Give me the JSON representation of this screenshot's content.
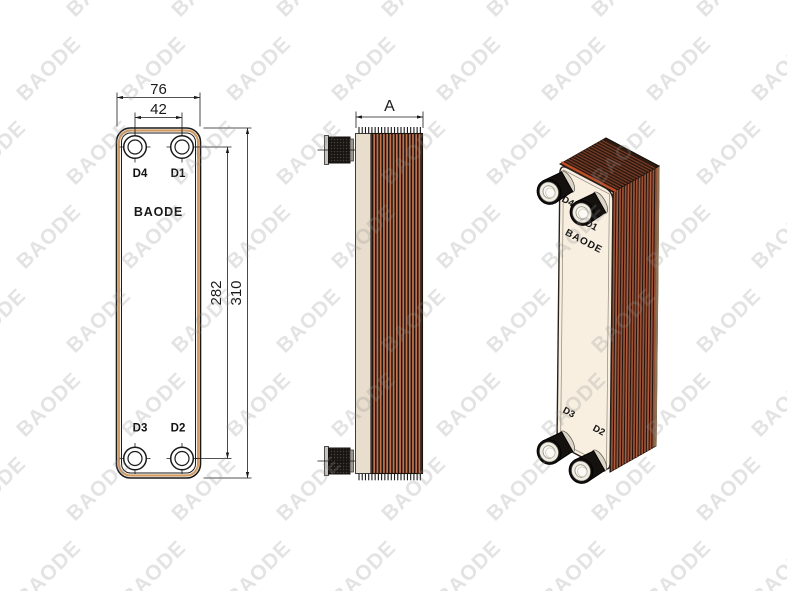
{
  "title": "Brazed plate heat exchanger technical drawing",
  "watermark": {
    "text": "BAODE"
  },
  "front_view": {
    "brand_label": "BAODE",
    "dimensions": {
      "overall_width": "76",
      "port_horizontal_spacing": "42",
      "port_vertical_spacing": "282",
      "overall_height": "310"
    },
    "ports": {
      "top_left": "D4",
      "top_right": "D1",
      "bottom_left": "D3",
      "bottom_right": "D2"
    }
  },
  "side_view": {
    "depth_dimension": "A"
  },
  "iso_view": {
    "brand_label": "BAODE",
    "ports": {
      "top_left": "D4",
      "top_right": "D1",
      "bottom_left": "D3",
      "bottom_right": "D2"
    }
  },
  "colors": {
    "drawing_line": "#1a1a1a",
    "plate_copper": "#c1734e",
    "stripe_dark": "#1f1410",
    "gasket_tan": "#d29a62",
    "front_face_cream": "#f8efe1",
    "side_plate_cream": "#e9decd",
    "iso_face_dark": "#241410",
    "iso_stripe": "#9a5134",
    "iso_stripe_alt": "#aa5c3c",
    "iso_back_band": "#8c7054",
    "iso_top_dark": "#2d1a10",
    "iso_top_stripe": "#7c3d27",
    "braze_orange": "#c04e28",
    "watermark": "#909090"
  }
}
